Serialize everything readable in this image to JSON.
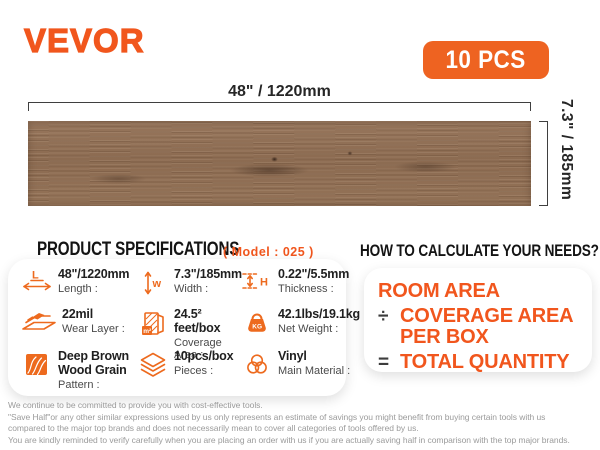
{
  "brand": {
    "logo": "VEVOR",
    "badge_label": "10 PCS"
  },
  "plank": {
    "length_label": "48\" / 1220mm",
    "width_label": "7.3\" / 185mm"
  },
  "specs": {
    "heading": "PRODUCT SPECIFICATIONS",
    "model": "( Model : 025 )",
    "items": [
      {
        "icon": "length-icon",
        "value": "48\"/1220mm",
        "label": "Length :"
      },
      {
        "icon": "width-icon",
        "value": "7.3\"/185mm",
        "label": "Width :"
      },
      {
        "icon": "thickness-icon",
        "value": "0.22\"/5.5mm",
        "label": "Thickness :"
      },
      {
        "icon": "wear-layer-icon",
        "value": "22mil",
        "label": "Wear Layer :"
      },
      {
        "icon": "coverage-area-icon",
        "value": "24.5² feet/box",
        "label": "Coverage Area :"
      },
      {
        "icon": "net-weight-icon",
        "value": "42.1lbs/19.1kg",
        "label": "Net Weight :"
      },
      {
        "icon": "pattern-icon",
        "value": "Deep Brown Wood Grain",
        "label": "Pattern :"
      },
      {
        "icon": "pieces-icon",
        "value": "10pcs/box",
        "label": "Pieces :"
      },
      {
        "icon": "material-icon",
        "value": "Vinyl",
        "label": "Main Material :"
      }
    ]
  },
  "calculate": {
    "heading": "HOW TO CALCULATE YOUR NEEDS?",
    "room_area": "ROOM AREA",
    "divide_sign": "÷",
    "coverage_area": "COVERAGE AREA PER BOX",
    "equals_sign": "=",
    "total_quantity": "TOTAL QUANTITY"
  },
  "icons": {
    "length_letter": "L",
    "width_letter": "w",
    "thickness_letter": "H",
    "coverage_label": "m²",
    "weight_label": "KG"
  },
  "footer": {
    "lines": [
      "We continue to be committed to provide you with cost-effective tools.",
      "\"Save Half\"or any other similar expressions used by us only represents an estimate of savings you might benefit from buying certain tools with us",
      "compared to the major top brands and does not necessarily mean to cover all categories of tools offered by us.",
      "You are kindly reminded to verify carefully when you are placing an order with us if you are actually saving half in comparison with the top major brands."
    ]
  },
  "colors": {
    "accent": "#f1561d",
    "icon_orange": "#ed6a1e",
    "badge_bg": "#ee6321",
    "heading": "#141414",
    "value_text": "#1f1f1f",
    "label_text": "#4a4a4a",
    "dimension": "#3f3f3f",
    "operator": "#3c3c3c",
    "footer_text": "#9b9b9b",
    "plank_base": "#8c6b51"
  }
}
